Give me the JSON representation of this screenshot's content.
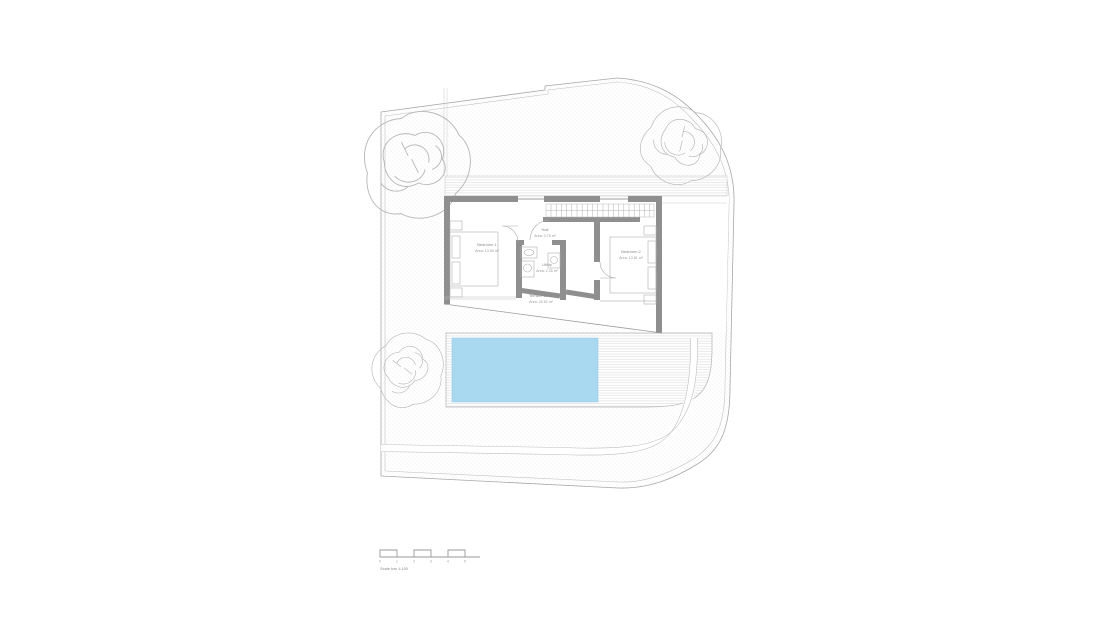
{
  "plan": {
    "rooms": [
      {
        "name": "Bedroom 1",
        "area": "Area: 13.55 m²"
      },
      {
        "name": "Hall",
        "area": "Area: 3.75 m²"
      },
      {
        "name": "Utility",
        "area": "Area: 2.35 m²"
      },
      {
        "name": "Bedroom 2",
        "area": "Area: 13.81 m²"
      },
      {
        "name": "Terrace 1st fl.",
        "area": "Area: 20.62 m²"
      }
    ],
    "scale_bar": {
      "label": "Scale bar 1:100",
      "ticks": [
        "0",
        "1",
        "2",
        "3",
        "4",
        "5"
      ]
    },
    "colors": {
      "pool": "#a9d9f1",
      "wall": "#8f8f8f",
      "line": "#a8a8a8",
      "texture_dot": "#c9c9c9"
    }
  }
}
